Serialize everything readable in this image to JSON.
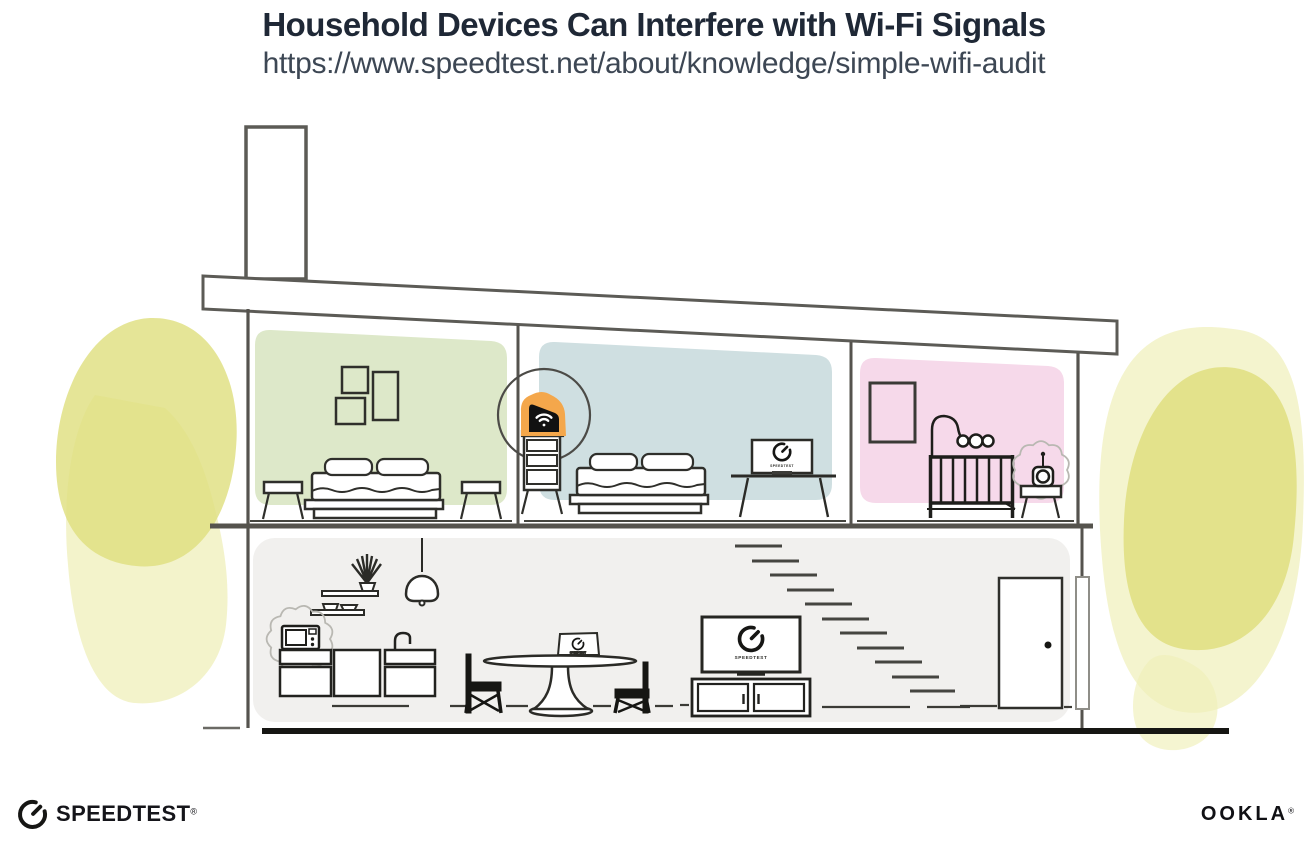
{
  "header": {
    "title": "Household Devices Can Interfere with Wi-Fi Signals",
    "url": "https://www.speedtest.net/about/knowledge/simple-wifi-audit"
  },
  "screens": {
    "speedtest_label": "SPEEDTEST"
  },
  "branding": {
    "speedtest_wordmark": "SPEEDTEST",
    "speedtest_registered": "®",
    "ookla_wordmark": "OOKLA",
    "ookla_registered": "®"
  },
  "icons": {
    "speedtest_gauge": "open circular gauge with needle pointing upper-right",
    "wifi": "wi-fi dot with two arcs",
    "router_highlight": "orange blob behind black router",
    "interference": "scalloped squiggle ring around interfering device"
  },
  "colors": {
    "title_text": "#1f2836",
    "url_text": "#3d4754",
    "wall_line": "#5c5b56",
    "dark_line": "#2b2b27",
    "ink": "#15151a",
    "room_green": "#dde8c9",
    "room_blue": "#cfdfe1",
    "room_pink": "#f6d9ea",
    "room_gray": "#f1f0ee",
    "router_orange": "#f4a74b",
    "foliage_yellow": "#dfde7d",
    "foliage_yellow_light": "#efefb9",
    "interference_gray": "#b9b8b2"
  },
  "scene": {
    "upper_floor_rooms": [
      {
        "name": "green bedroom",
        "items": [
          "three wall frames",
          "double bed",
          "two nightstands"
        ]
      },
      {
        "name": "blue bedroom",
        "items": [
          "wi-fi router highlighted on dresser",
          "double bed",
          "desk monitor running Speedtest"
        ]
      },
      {
        "name": "pink nursery",
        "items": [
          "wall frame",
          "crib with mobile",
          "baby monitor with interference"
        ]
      }
    ],
    "ground_floor_items": [
      "shelves with plant",
      "pendant lamp",
      "microwave with interference",
      "kitchen cabinets with faucet",
      "dining table with laptop running Speedtest",
      "two chairs",
      "tv running Speedtest on media console",
      "floating staircase",
      "front door",
      "downspout"
    ]
  }
}
